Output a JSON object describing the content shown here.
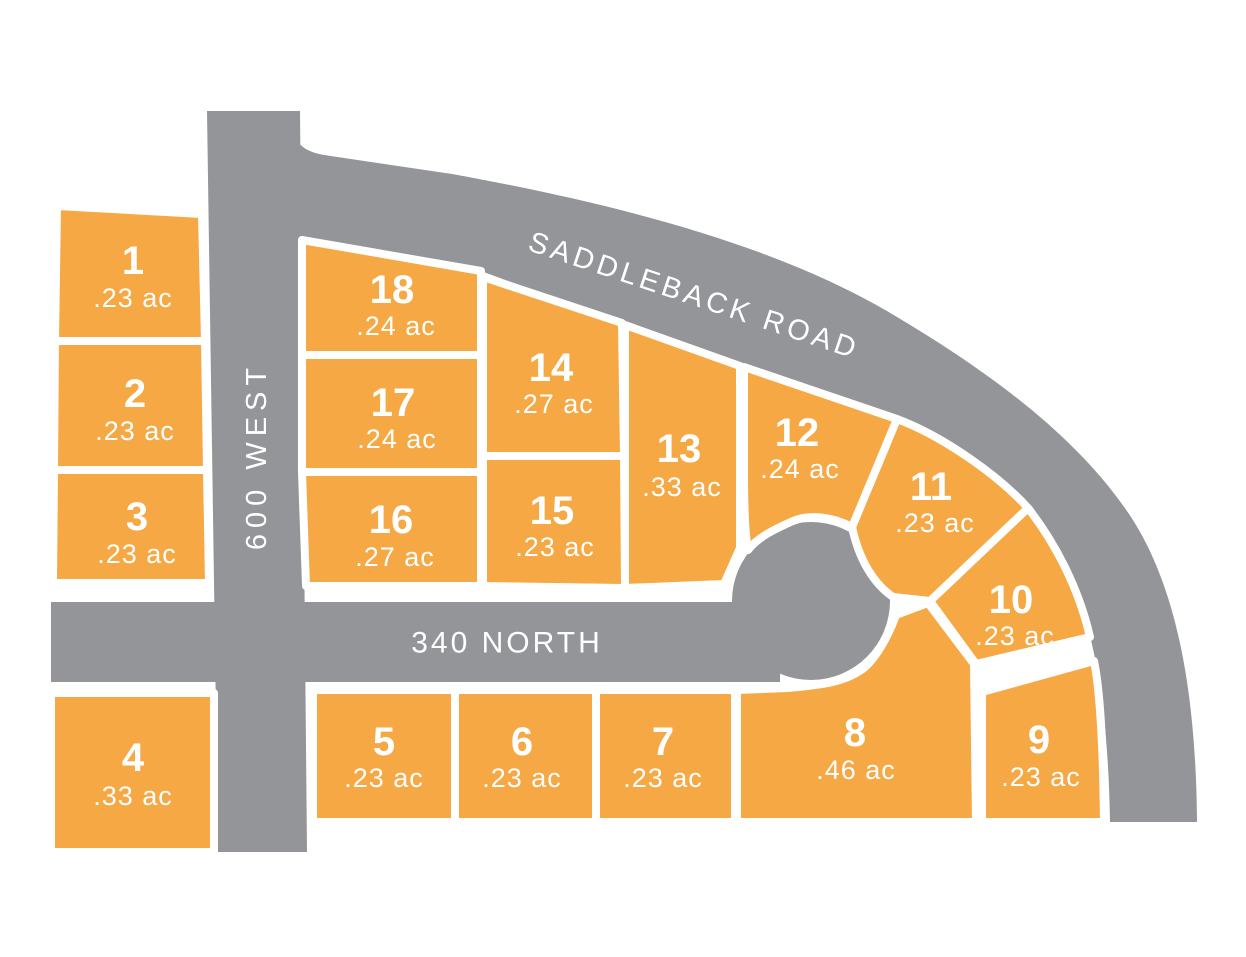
{
  "map": {
    "colors": {
      "lot_fill": "#F5A843",
      "road_fill": "#939598",
      "lot_outline": "#FFFFFF",
      "label_text": "#FFFFFF",
      "background": "#FFFFFF"
    },
    "roads": {
      "saddleback": "SADDLEBACK ROAD",
      "west_600": "600 WEST",
      "north_340": "340 NORTH"
    },
    "lots": [
      {
        "number": "1",
        "area": ".23 ac"
      },
      {
        "number": "2",
        "area": ".23 ac"
      },
      {
        "number": "3",
        "area": ".23 ac"
      },
      {
        "number": "4",
        "area": ".33 ac"
      },
      {
        "number": "5",
        "area": ".23 ac"
      },
      {
        "number": "6",
        "area": ".23 ac"
      },
      {
        "number": "7",
        "area": ".23 ac"
      },
      {
        "number": "8",
        "area": ".46 ac"
      },
      {
        "number": "9",
        "area": ".23 ac"
      },
      {
        "number": "10",
        "area": ".23 ac"
      },
      {
        "number": "11",
        "area": ".23 ac"
      },
      {
        "number": "12",
        "area": ".24 ac"
      },
      {
        "number": "13",
        "area": ".33 ac"
      },
      {
        "number": "14",
        "area": ".27 ac"
      },
      {
        "number": "15",
        "area": ".23 ac"
      },
      {
        "number": "16",
        "area": ".27 ac"
      },
      {
        "number": "17",
        "area": ".24 ac"
      },
      {
        "number": "18",
        "area": ".24 ac"
      }
    ]
  }
}
